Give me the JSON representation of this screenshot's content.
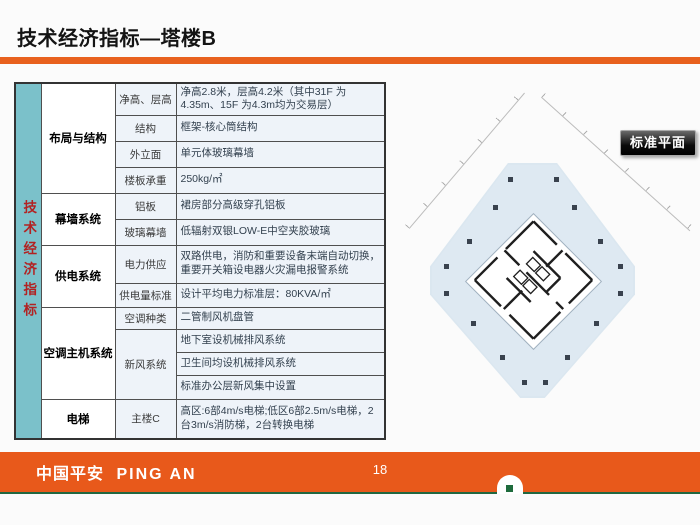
{
  "header": {
    "title": "技术经济指标—塔楼B"
  },
  "table": {
    "vertical_header": "技术经济指标",
    "sections": [
      {
        "category": "布局与结构",
        "items": [
          {
            "label": "净高、层高",
            "value": "净高2.8米，层高4.2米（其中31F 为4.35m、15F 为4.3m均为交易层）"
          },
          {
            "label": "结构",
            "value": "框架-核心筒结构"
          },
          {
            "label": "外立面",
            "value": "单元体玻璃幕墙"
          },
          {
            "label": "楼板承重",
            "value": "250kg/㎡"
          }
        ]
      },
      {
        "category": "幕墙系统",
        "items": [
          {
            "label": "铝板",
            "value": "裙房部分高级穿孔铝板"
          },
          {
            "label": "玻璃幕墙",
            "value": "低辐射双银LOW-E中空夹胶玻璃"
          }
        ]
      },
      {
        "category": "供电系统",
        "items": [
          {
            "label": "电力供应",
            "value": "双路供电，消防和重要设备末端自动切换，重要开关箱设电器火灾漏电报警系统"
          },
          {
            "label": "供电量标准",
            "value": "设计平均电力标准层：80KVA/㎡"
          }
        ]
      },
      {
        "category": "空调主机系统",
        "items": [
          {
            "label": "空调种类",
            "value": "二管制风机盘管"
          },
          {
            "label": "新风系统",
            "values": [
              "地下室设机械排风系统",
              "卫生间均设机械排风系统",
              "标准办公层新风集中设置"
            ]
          }
        ]
      },
      {
        "category": "电梯",
        "items": [
          {
            "label": "主楼C",
            "value": "高区:6部4m/s电梯;低区6部2.5m/s电梯，2台3m/s消防梯，2台转换电梯"
          }
        ]
      }
    ]
  },
  "floor_plan": {
    "label": "标准平面"
  },
  "footer": {
    "logo_cn": "中国平安",
    "logo_en": "PING AN",
    "page_number": "18"
  },
  "colors": {
    "accent_orange": "#E8611E",
    "footer_orange": "#E8591B",
    "footer_green": "#226741",
    "header_teal": "#7BC1CA",
    "vertical_text_red": "#B22222",
    "cell_bg": "#EEF3F9",
    "floor_plate_blue": "#DBE7F0"
  }
}
